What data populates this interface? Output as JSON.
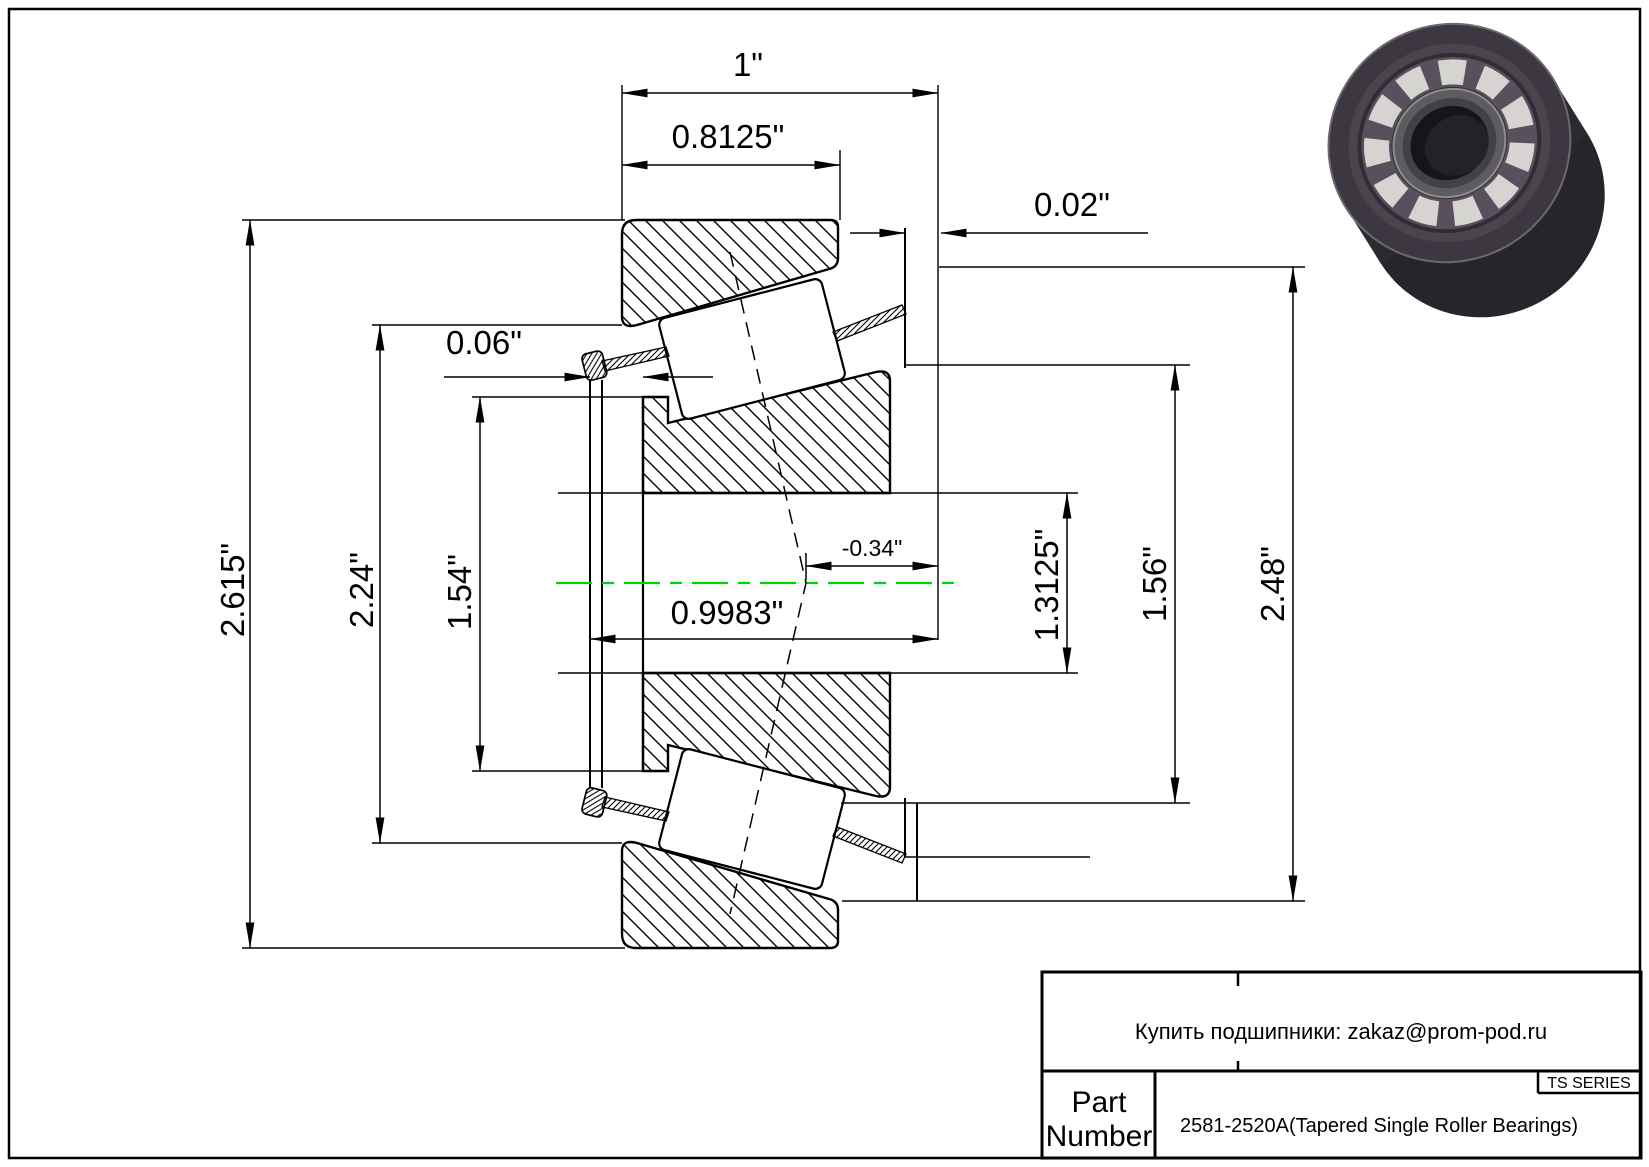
{
  "page": {
    "background": "#ffffff",
    "line_color": "#000000",
    "centerline_color": "#00d400"
  },
  "dims": {
    "total_width": "1\"",
    "cup_width": "0.8125\"",
    "back_protrusion": "0.02\"",
    "front_protrusion": "0.06\"",
    "flange_diameter": "2.615\"",
    "cage_diameter": "2.24\"",
    "front_diameter": "1.54\"",
    "cage_width": "0.9983\"",
    "effective_center": "-0.34\"",
    "bore_diameter": "1.3125\"",
    "back_diameter": "1.56\"",
    "outer_diameter": "2.48\""
  },
  "title_block": {
    "seller_note": "Купить подшипники: zakaz@prom-pod.ru",
    "series_label": "TS SERIES",
    "part_label_line1": "Part",
    "part_label_line2": "Number",
    "part_number": "2581-2520A(Tapered Single Roller Bearings)"
  },
  "product_image": {
    "name": "tapered-roller-bearing-3d-render",
    "ring_color": "#332e36",
    "roller_color": "#d6d4d1",
    "cage_color": "#5a4f5c"
  }
}
